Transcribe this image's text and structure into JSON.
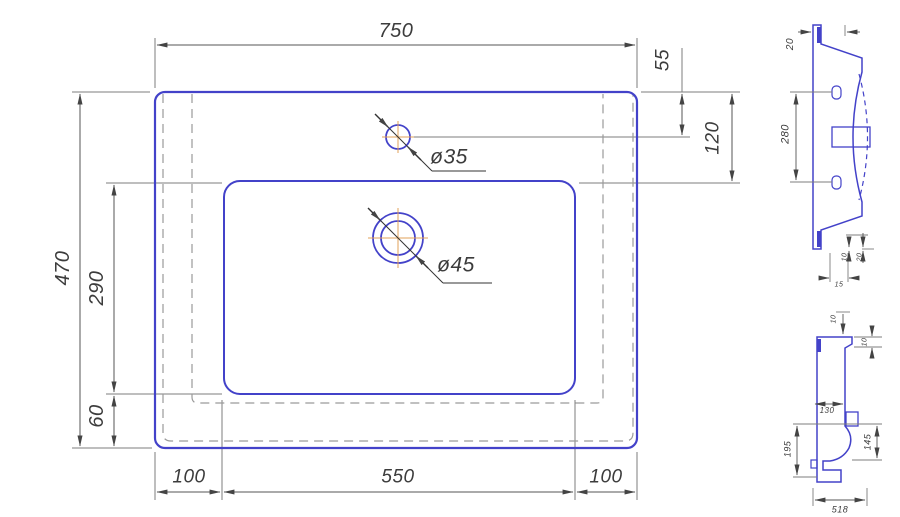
{
  "plan": {
    "width": "750",
    "height": "470",
    "basin_height": "290",
    "bottom_margin": "60",
    "tap_hole_offset": "55",
    "deck_depth": "120",
    "left_margin": "100",
    "basin_width": "550",
    "right_margin": "100",
    "tap_hole_dia": "ø35",
    "drain_hole_dia": "ø45"
  },
  "side_section": {
    "flange": "20",
    "hole_spacing": "280",
    "edge_small": "10",
    "edge_large": "20",
    "lip": "15"
  },
  "front_section": {
    "rim": "10",
    "flange": "10",
    "wall": "130",
    "back_height": "195",
    "front_height": "145",
    "length": "518"
  },
  "colors": {
    "outline": "#4342c9",
    "hidden_dashed": "#9a9a9a",
    "dimension": "#5a5a5a",
    "centerline": "#e2a25a",
    "text": "#3c3c3c"
  }
}
